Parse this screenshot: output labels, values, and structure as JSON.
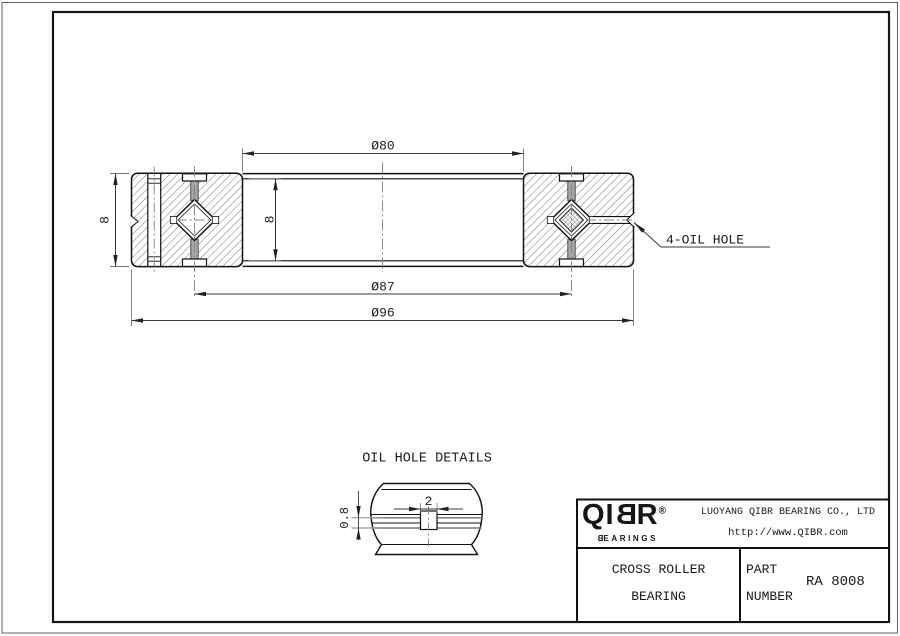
{
  "page": {
    "background": "#ffffff",
    "line_color": "#1a1a1a"
  },
  "dimensions": {
    "bore_diameter": "Ø80",
    "roller_pitch_diameter": "Ø87",
    "outer_diameter": "Ø96",
    "section_height": "8",
    "inner_ring_height": "8",
    "oil_hole_callout": "4-OIL HOLE"
  },
  "detail_view": {
    "title": "OIL HOLE DETAILS",
    "hole_diameter": "2",
    "hole_depth": "0.8"
  },
  "title_block": {
    "logo": {
      "part1": "QI",
      "mirrored_b": "B",
      "part2": "R",
      "registered": "®",
      "brand_b": "B",
      "brand_rest": "EARINGS"
    },
    "company": "LUOYANG QIBR BEARING CO., LTD",
    "website": "http://www.QIBR.com",
    "product": {
      "line1": "CROSS ROLLER",
      "line2": "BEARING"
    },
    "part_label": {
      "line1": "PART",
      "line2": "NUMBER"
    },
    "part_number": "RA 8008"
  }
}
